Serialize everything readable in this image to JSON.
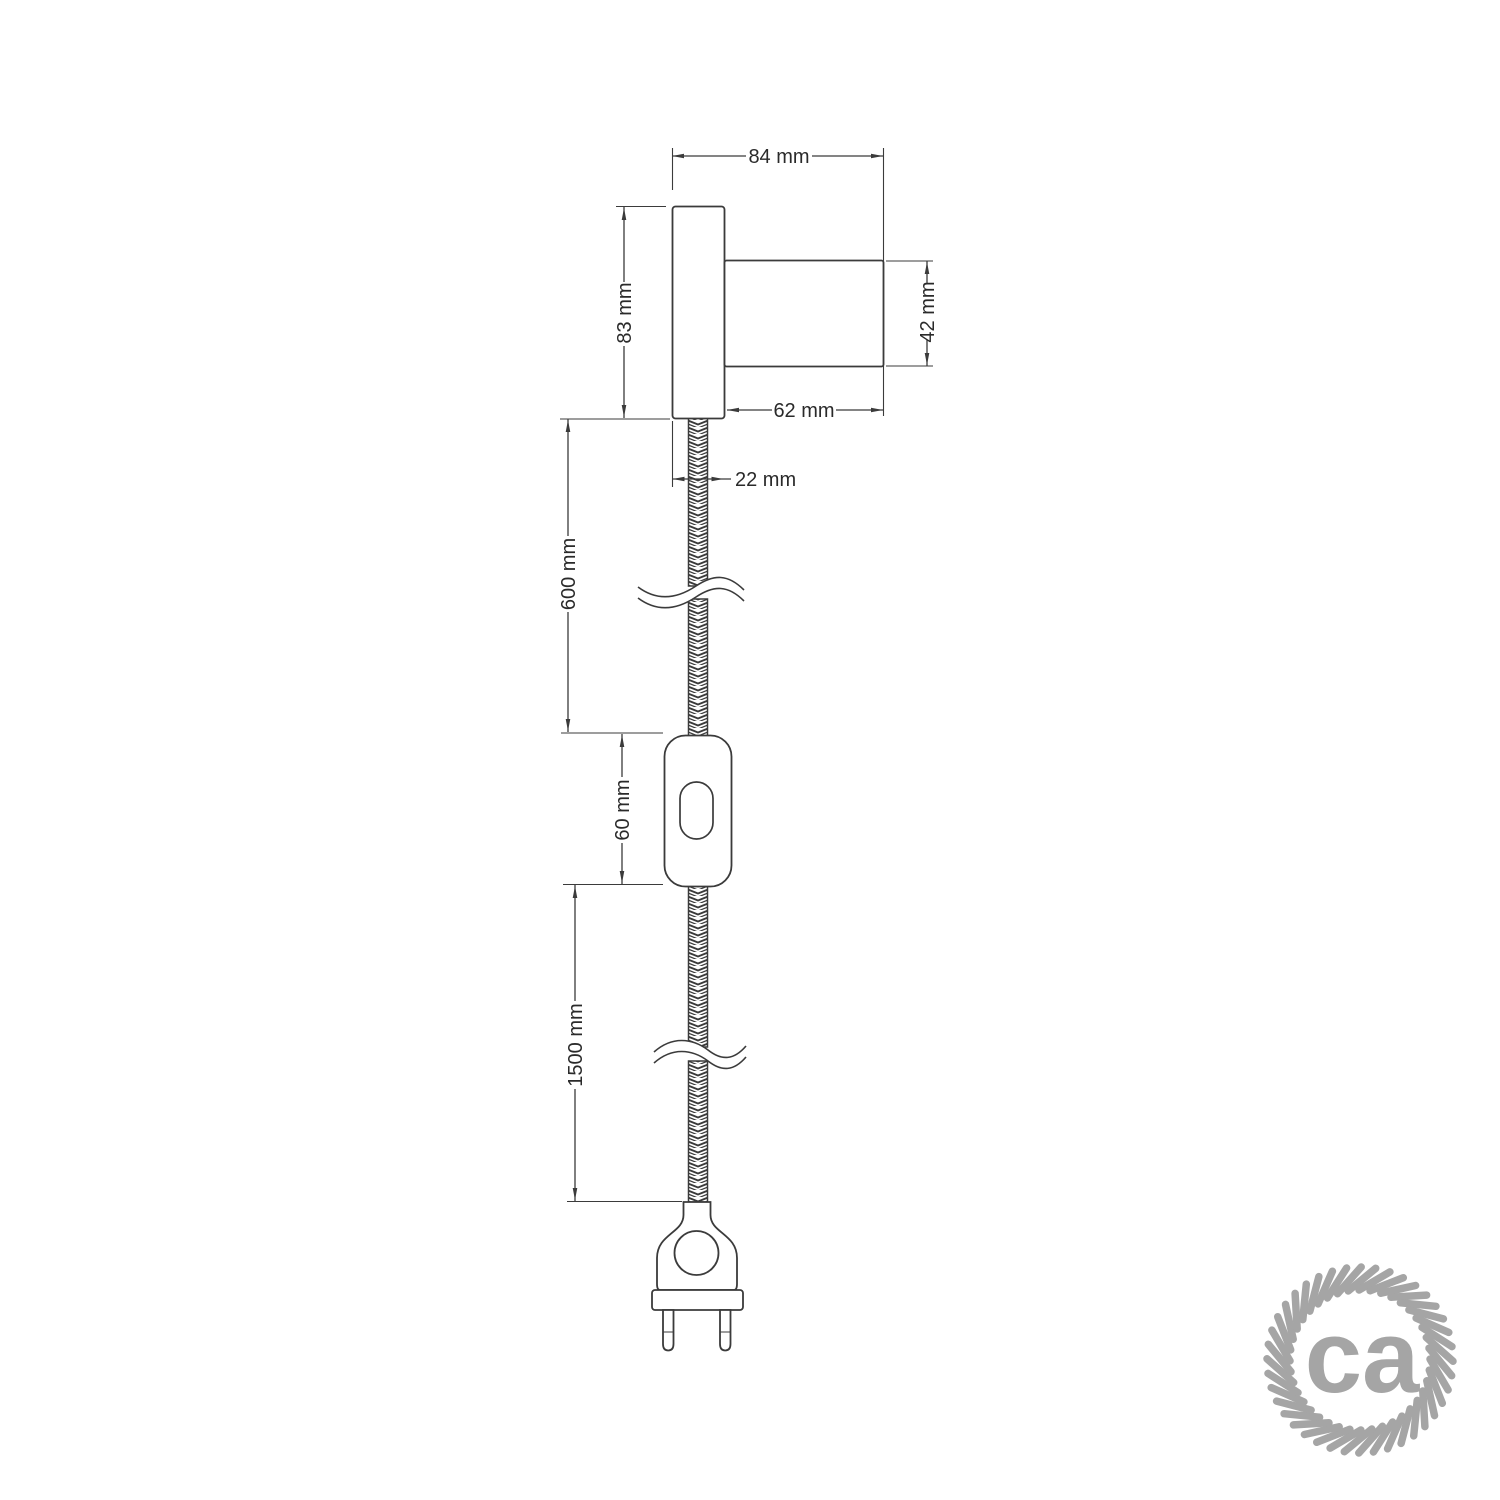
{
  "title": "Wall spotlight with braided cable, switch and plug - dimensional drawing",
  "colors": {
    "background": "#ffffff",
    "line": "#3b3b3b",
    "text": "#2a2a2a",
    "logo": "#a5a5a5"
  },
  "dimensions": {
    "overall_depth": {
      "label": "84 mm"
    },
    "base_diameter": {
      "label": "83 mm"
    },
    "socket_diameter": {
      "label": "42 mm"
    },
    "socket_length": {
      "label": "62 mm"
    },
    "base_depth": {
      "label": "22 mm"
    },
    "cable_upper_length": {
      "label": "600 mm"
    },
    "switch_length": {
      "label": "60 mm"
    },
    "cable_lower_length": {
      "label": "1500 mm"
    }
  },
  "logo": {
    "text": "ca",
    "strands": 40,
    "ring_color": "#a5a5a5"
  }
}
